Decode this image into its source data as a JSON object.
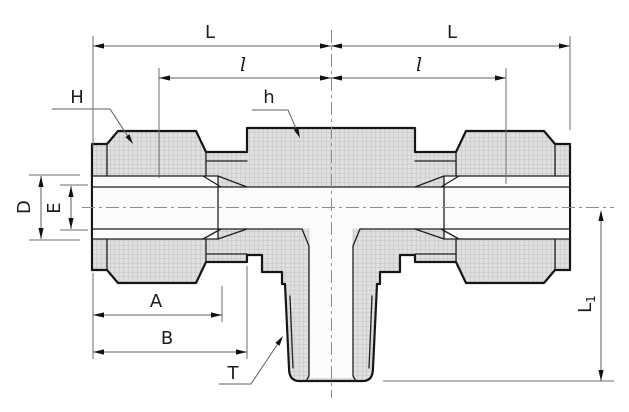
{
  "drawing": {
    "kind": "technical-dimension-diagram",
    "subject": "tee compression fitting cross-section"
  },
  "labels": {
    "L_left": "L",
    "L_right": "L",
    "l_left": "l",
    "l_right": "l",
    "H": "H",
    "h": "h",
    "D": "D",
    "E": "E",
    "A": "A",
    "B": "B",
    "T": "T",
    "L1_main": "L",
    "L1_sub": "1"
  },
  "colors": {
    "background": "#ffffff",
    "metal_fill": "#e0e0e0",
    "metal_hatch": "#c4c4c4",
    "outline": "#161616",
    "detail_line": "#1f1f1f",
    "dimension_line": "#5f5f5f",
    "label_text": "#1c1c1c",
    "bore_fill": "#fbfbfb"
  }
}
